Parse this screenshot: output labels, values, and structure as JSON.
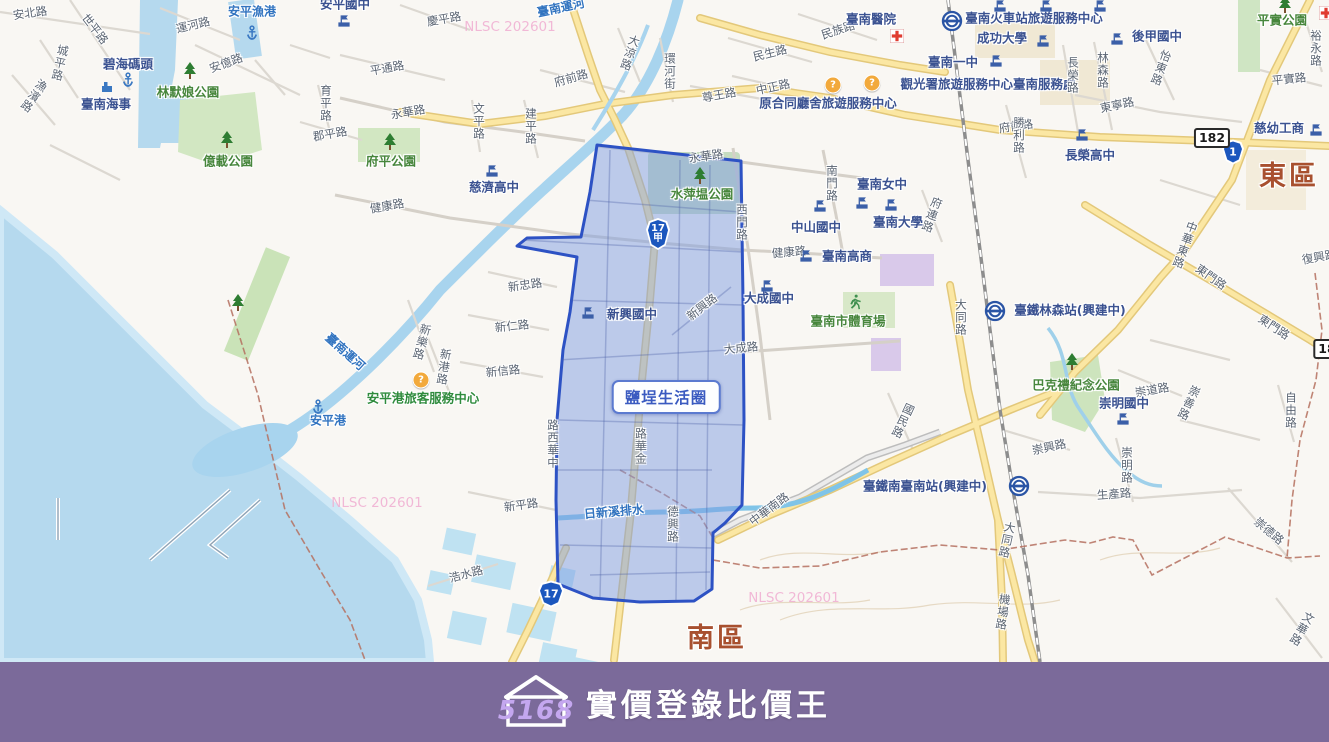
{
  "brand": {
    "logo_number": "5168",
    "title": "實價登錄比價王"
  },
  "map": {
    "region_label": "鹽埕生活圈",
    "watermark_text": "NLSC 202601",
    "watermarks": [
      {
        "x": 510,
        "y": 27
      },
      {
        "x": 377,
        "y": 503
      },
      {
        "x": 794,
        "y": 598
      }
    ],
    "labels": [
      {
        "t": "安北路",
        "x": 30,
        "y": 13,
        "c": "road",
        "r": -8
      },
      {
        "t": "世平路",
        "x": 95,
        "y": 29,
        "c": "road",
        "r": 52
      },
      {
        "t": "城平路",
        "x": 60,
        "y": 63,
        "c": "road",
        "v": 1,
        "r": 12
      },
      {
        "t": "漁濱路",
        "x": 34,
        "y": 96,
        "c": "road",
        "v": 1,
        "r": 35
      },
      {
        "t": "運河路",
        "x": 193,
        "y": 25,
        "c": "road",
        "r": -14
      },
      {
        "t": "安平漁港",
        "x": 252,
        "y": 12,
        "c": "blue"
      },
      {
        "t": "碧海碼頭",
        "x": 128,
        "y": 64,
        "c": "navy"
      },
      {
        "t": "臺南海事",
        "x": 106,
        "y": 104,
        "c": "navy"
      },
      {
        "t": "林默娘公園",
        "x": 188,
        "y": 92,
        "c": "park"
      },
      {
        "t": "安億路",
        "x": 226,
        "y": 63,
        "c": "road",
        "r": -20
      },
      {
        "t": "億載公園",
        "x": 228,
        "y": 161,
        "c": "park"
      },
      {
        "t": "安平國中",
        "x": 345,
        "y": 4,
        "c": "navy"
      },
      {
        "t": "慶平路",
        "x": 444,
        "y": 19,
        "c": "road",
        "r": -10
      },
      {
        "t": "平通路",
        "x": 387,
        "y": 68,
        "c": "road",
        "r": -10
      },
      {
        "t": "永華路",
        "x": 408,
        "y": 112,
        "c": "road",
        "r": -10
      },
      {
        "t": "育平路",
        "x": 326,
        "y": 103,
        "c": "road",
        "v": 1
      },
      {
        "t": "郡平路",
        "x": 330,
        "y": 134,
        "c": "road",
        "r": -10
      },
      {
        "t": "府平公園",
        "x": 391,
        "y": 161,
        "c": "park"
      },
      {
        "t": "健康路",
        "x": 387,
        "y": 206,
        "c": "road",
        "r": -10
      },
      {
        "t": "臺南運河",
        "x": 561,
        "y": 8,
        "c": "blue",
        "r": -12
      },
      {
        "t": "大涼路",
        "x": 630,
        "y": 53,
        "c": "road",
        "v": 1,
        "r": 18
      },
      {
        "t": "環河街",
        "x": 670,
        "y": 71,
        "c": "road",
        "v": 1
      },
      {
        "t": "府前路",
        "x": 571,
        "y": 78,
        "c": "road",
        "r": -16
      },
      {
        "t": "文平路",
        "x": 479,
        "y": 121,
        "c": "road",
        "v": 1
      },
      {
        "t": "建平路",
        "x": 531,
        "y": 126,
        "c": "road",
        "v": 1
      },
      {
        "t": "慈濟高中",
        "x": 494,
        "y": 187,
        "c": "navy"
      },
      {
        "t": "尊王路",
        "x": 719,
        "y": 95,
        "c": "road",
        "r": -10
      },
      {
        "t": "民生路",
        "x": 770,
        "y": 53,
        "c": "road",
        "r": -14
      },
      {
        "t": "民族路",
        "x": 838,
        "y": 30,
        "c": "road",
        "r": -18
      },
      {
        "t": "中正路",
        "x": 773,
        "y": 87,
        "c": "road",
        "r": -12
      },
      {
        "t": "原合同廳舍旅遊服務中心",
        "x": 828,
        "y": 103,
        "c": "navy"
      },
      {
        "t": "府前路",
        "x": 1016,
        "y": 126,
        "c": "road",
        "r": -8
      },
      {
        "t": "臺南醫院",
        "x": 871,
        "y": 19,
        "c": "navy"
      },
      {
        "t": "臺南火車站旅遊服務中心",
        "x": 1034,
        "y": 18,
        "c": "navy"
      },
      {
        "t": "成功大學",
        "x": 1002,
        "y": 38,
        "c": "navy"
      },
      {
        "t": "臺南一中",
        "x": 953,
        "y": 62,
        "c": "navy"
      },
      {
        "t": "後甲國中",
        "x": 1157,
        "y": 36,
        "c": "navy"
      },
      {
        "t": "觀光署旅遊服務中心臺南服務處",
        "x": 988,
        "y": 84,
        "c": "navy"
      },
      {
        "t": "長榮路",
        "x": 1073,
        "y": 75,
        "c": "road",
        "v": 1
      },
      {
        "t": "林森路",
        "x": 1103,
        "y": 70,
        "c": "road",
        "v": 1
      },
      {
        "t": "怡東路",
        "x": 1161,
        "y": 68,
        "c": "road",
        "v": 1,
        "r": 20
      },
      {
        "t": "東寧路",
        "x": 1117,
        "y": 105,
        "c": "road",
        "r": -12
      },
      {
        "t": "勝利路",
        "x": 1019,
        "y": 135,
        "c": "road",
        "v": 1
      },
      {
        "t": "長榮高中",
        "x": 1090,
        "y": 155,
        "c": "navy"
      },
      {
        "t": "平實公園",
        "x": 1282,
        "y": 20,
        "c": "park"
      },
      {
        "t": "裕永路",
        "x": 1316,
        "y": 48,
        "c": "road",
        "v": 1
      },
      {
        "t": "平實路",
        "x": 1289,
        "y": 79,
        "c": "road",
        "r": -6
      },
      {
        "t": "慈幼工商",
        "x": 1279,
        "y": 128,
        "c": "navy"
      },
      {
        "t": "東區",
        "x": 1289,
        "y": 177,
        "c": "district"
      },
      {
        "t": "復興路",
        "x": 1319,
        "y": 257,
        "c": "road",
        "r": -10
      },
      {
        "t": "中華東路",
        "x": 1185,
        "y": 245,
        "c": "road",
        "v": 1,
        "r": 20
      },
      {
        "t": "東門路",
        "x": 1211,
        "y": 277,
        "c": "road",
        "r": 35
      },
      {
        "t": "東門路",
        "x": 1274,
        "y": 327,
        "c": "road",
        "r": 33
      },
      {
        "t": "南門路",
        "x": 832,
        "y": 183,
        "c": "road",
        "v": 1
      },
      {
        "t": "臺南女中",
        "x": 882,
        "y": 184,
        "c": "navy"
      },
      {
        "t": "府連路",
        "x": 932,
        "y": 215,
        "c": "road",
        "v": 1,
        "r": 20
      },
      {
        "t": "臺南大學",
        "x": 898,
        "y": 222,
        "c": "navy"
      },
      {
        "t": "中山國中",
        "x": 816,
        "y": 227,
        "c": "navy"
      },
      {
        "t": "臺南高商",
        "x": 847,
        "y": 256,
        "c": "navy"
      },
      {
        "t": "健康路",
        "x": 789,
        "y": 252,
        "c": "road",
        "r": -5
      },
      {
        "t": "西門路",
        "x": 742,
        "y": 222,
        "c": "road",
        "v": 1
      },
      {
        "t": "永華路",
        "x": 706,
        "y": 156,
        "c": "road",
        "r": -8
      },
      {
        "t": "水萍塭公園",
        "x": 702,
        "y": 194,
        "c": "park"
      },
      {
        "t": "新忠路",
        "x": 525,
        "y": 285,
        "c": "road",
        "r": -8
      },
      {
        "t": "新仁路",
        "x": 512,
        "y": 326,
        "c": "road",
        "r": -6
      },
      {
        "t": "新信路",
        "x": 503,
        "y": 371,
        "c": "road",
        "r": -6
      },
      {
        "t": "新樂路",
        "x": 422,
        "y": 342,
        "c": "road",
        "v": 1,
        "r": 15
      },
      {
        "t": "新港路",
        "x": 444,
        "y": 367,
        "c": "road",
        "v": 1,
        "r": 8
      },
      {
        "t": "安平港旅客服務中心",
        "x": 423,
        "y": 398,
        "c": "green"
      },
      {
        "t": "安平港",
        "x": 328,
        "y": 421,
        "c": "blue"
      },
      {
        "t": "臺南運河",
        "x": 345,
        "y": 352,
        "c": "blue",
        "r": 42
      },
      {
        "t": "新興國中",
        "x": 632,
        "y": 314,
        "c": "navy"
      },
      {
        "t": "新興路",
        "x": 702,
        "y": 307,
        "c": "road",
        "r": -38
      },
      {
        "t": "大成國中",
        "x": 769,
        "y": 298,
        "c": "navy"
      },
      {
        "t": "大成路",
        "x": 741,
        "y": 348,
        "c": "road",
        "r": -6
      },
      {
        "t": "臺南市體育場",
        "x": 848,
        "y": 321,
        "c": "park"
      },
      {
        "t": "國民路",
        "x": 903,
        "y": 421,
        "c": "road",
        "v": 1,
        "r": 25
      },
      {
        "t": "臺鐵林森站(興建中)",
        "x": 1070,
        "y": 310,
        "c": "navy"
      },
      {
        "t": "大同路",
        "x": 961,
        "y": 317,
        "c": "road",
        "v": 1
      },
      {
        "t": "巴克禮紀念公園",
        "x": 1076,
        "y": 385,
        "c": "park"
      },
      {
        "t": "崇道路",
        "x": 1152,
        "y": 390,
        "c": "road",
        "r": -10
      },
      {
        "t": "崇明國中",
        "x": 1124,
        "y": 403,
        "c": "navy"
      },
      {
        "t": "崇善路",
        "x": 1189,
        "y": 403,
        "c": "road",
        "v": 1,
        "r": 25
      },
      {
        "t": "自由路",
        "x": 1291,
        "y": 410,
        "c": "road",
        "v": 1
      },
      {
        "t": "崇興路",
        "x": 1049,
        "y": 447,
        "c": "road",
        "r": -12
      },
      {
        "t": "崇明路",
        "x": 1127,
        "y": 465,
        "c": "road",
        "v": 1
      },
      {
        "t": "生產路",
        "x": 1114,
        "y": 494,
        "c": "road",
        "r": -4
      },
      {
        "t": "臺鐵南臺南站(興建中)",
        "x": 925,
        "y": 486,
        "c": "navy"
      },
      {
        "t": "大同路",
        "x": 1007,
        "y": 540,
        "c": "road",
        "v": 1,
        "r": 12
      },
      {
        "t": "機場路",
        "x": 1003,
        "y": 612,
        "c": "road",
        "v": 1,
        "r": 8
      },
      {
        "t": "崇德路",
        "x": 1269,
        "y": 531,
        "c": "road",
        "r": 40
      },
      {
        "t": "文華路",
        "x": 1302,
        "y": 629,
        "c": "road",
        "v": 1,
        "r": 30
      },
      {
        "t": "南區",
        "x": 717,
        "y": 639,
        "c": "district"
      },
      {
        "t": "中華西路",
        "x": 553,
        "y": 444,
        "c": "road",
        "v": 1,
        "rev": 1
      },
      {
        "t": "金華路",
        "x": 641,
        "y": 446,
        "c": "road",
        "v": 1,
        "rev": 1
      },
      {
        "t": "德興路",
        "x": 673,
        "y": 524,
        "c": "road",
        "v": 1
      },
      {
        "t": "日新溪排水",
        "x": 614,
        "y": 512,
        "c": "blue",
        "r": -5
      },
      {
        "t": "中華南路",
        "x": 769,
        "y": 509,
        "c": "road",
        "r": -37
      },
      {
        "t": "新平路",
        "x": 521,
        "y": 505,
        "c": "road",
        "r": -8
      },
      {
        "t": "浩水路",
        "x": 466,
        "y": 574,
        "c": "road",
        "r": -15
      }
    ],
    "icons": [
      {
        "k": "flag",
        "x": 344,
        "y": 21
      },
      {
        "k": "flag",
        "x": 492,
        "y": 171
      },
      {
        "k": "flag",
        "x": 1000,
        "y": 6
      },
      {
        "k": "flag",
        "x": 1046,
        "y": 6
      },
      {
        "k": "flag",
        "x": 1100,
        "y": 6
      },
      {
        "k": "flag",
        "x": 996,
        "y": 61
      },
      {
        "k": "flag",
        "x": 1043,
        "y": 41
      },
      {
        "k": "flag",
        "x": 1117,
        "y": 39
      },
      {
        "k": "flag",
        "x": 1082,
        "y": 135
      },
      {
        "k": "flag",
        "x": 1316,
        "y": 130
      },
      {
        "k": "flag",
        "x": 862,
        "y": 203
      },
      {
        "k": "flag",
        "x": 891,
        "y": 205
      },
      {
        "k": "flag",
        "x": 820,
        "y": 206
      },
      {
        "k": "flag",
        "x": 806,
        "y": 256
      },
      {
        "k": "flag",
        "x": 767,
        "y": 286
      },
      {
        "k": "flag",
        "x": 588,
        "y": 313
      },
      {
        "k": "flag",
        "x": 1123,
        "y": 419
      },
      {
        "k": "tree",
        "x": 190,
        "y": 71
      },
      {
        "k": "tree",
        "x": 227,
        "y": 140
      },
      {
        "k": "tree",
        "x": 390,
        "y": 142
      },
      {
        "k": "tree",
        "x": 700,
        "y": 176
      },
      {
        "k": "tree",
        "x": 1285,
        "y": 5
      },
      {
        "k": "tree",
        "x": 1072,
        "y": 362
      },
      {
        "k": "tree",
        "x": 238,
        "y": 303
      },
      {
        "k": "anchor",
        "x": 252,
        "y": 33
      },
      {
        "k": "anchor",
        "x": 128,
        "y": 80
      },
      {
        "k": "anchor",
        "x": 318,
        "y": 407
      },
      {
        "k": "pier",
        "x": 107,
        "y": 87
      },
      {
        "k": "tra",
        "x": 952,
        "y": 21
      },
      {
        "k": "tra",
        "x": 995,
        "y": 311
      },
      {
        "k": "tra",
        "x": 1019,
        "y": 486
      },
      {
        "k": "info",
        "x": 833,
        "y": 85
      },
      {
        "k": "info",
        "x": 872,
        "y": 83
      },
      {
        "k": "info",
        "x": 421,
        "y": 380
      },
      {
        "k": "hospital",
        "x": 897,
        "y": 36
      },
      {
        "k": "hospital",
        "x": 1326,
        "y": 13
      },
      {
        "k": "runner",
        "x": 855,
        "y": 302
      }
    ],
    "shields": [
      {
        "kind": "shield",
        "num": "1",
        "x": 1233,
        "y": 152,
        "w": 22,
        "h": 25
      },
      {
        "kind": "shield",
        "num": "17",
        "x": 551,
        "y": 594,
        "w": 26,
        "h": 27
      },
      {
        "kind": "shield",
        "num": "17",
        "sub": "甲",
        "x": 658,
        "y": 234,
        "w": 24,
        "h": 32
      },
      {
        "kind": "badge",
        "num": "182",
        "x": 1212,
        "y": 138
      },
      {
        "kind": "badge",
        "num": "18",
        "x": 1327,
        "y": 349
      }
    ]
  }
}
